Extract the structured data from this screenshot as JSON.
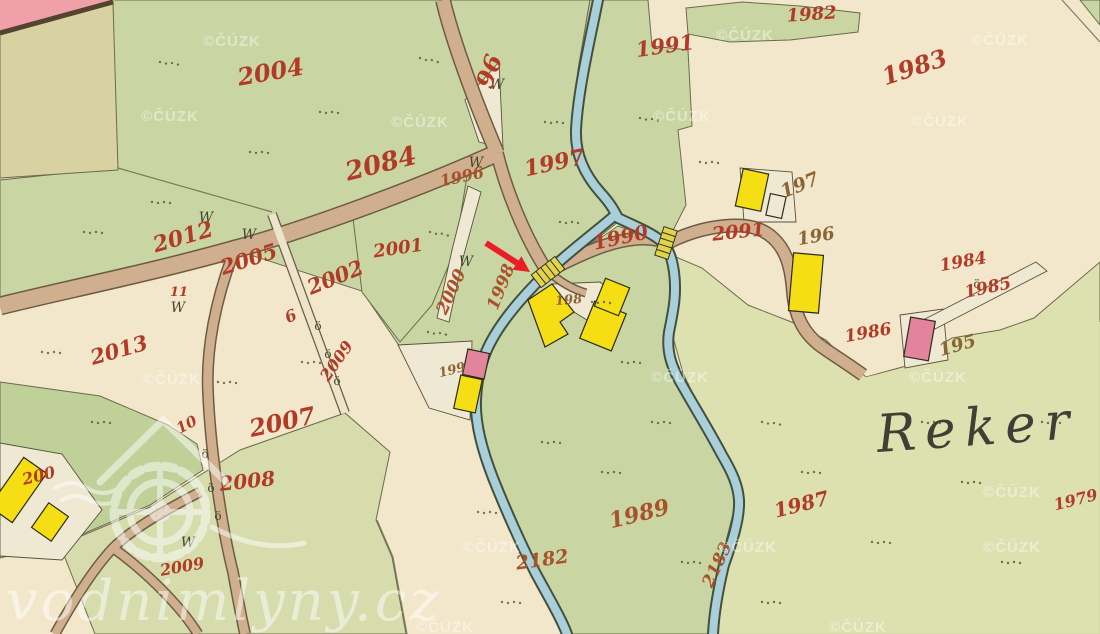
{
  "meta": {
    "title": "Historical cadastral map with water-mill location marker"
  },
  "watermarks": {
    "cuzk_text": "©ČÚZK",
    "cuzk_positions": [
      [
        232,
        46
      ],
      [
        170,
        121
      ],
      [
        420,
        127
      ],
      [
        745,
        40
      ],
      [
        1000,
        45
      ],
      [
        682,
        121
      ],
      [
        940,
        126
      ],
      [
        172,
        384
      ],
      [
        680,
        382
      ],
      [
        938,
        382
      ],
      [
        1012,
        497
      ],
      [
        492,
        552
      ],
      [
        748,
        552
      ],
      [
        1012,
        552
      ],
      [
        445,
        632
      ],
      [
        858,
        632
      ]
    ],
    "brand_text": "vodnimlyny.cz"
  },
  "place_label": {
    "text": "Reker"
  },
  "colors": {
    "paper": "#f2e7ca",
    "meadow": "#c9d6a3",
    "meadow_dark": "#bfd098",
    "meadow_pale": "#d6dcab",
    "meadow_se": "#dce1af",
    "boundary": "#6b6b4d",
    "white_parcel": "#efe8d2",
    "river": "#a8cfda",
    "river_edge": "#45503c",
    "road": "#cfaf8e",
    "road_edge": "#6d5c43",
    "lane": "#ece4cb",
    "building_wood": "#f6de14",
    "building_stone": "#e2849b",
    "bridge": "#e2d44a",
    "pink_area": "#efa0a8",
    "khaki_area": "#d8d2a2",
    "parcel_number": "#b23b28",
    "parcel_number_alt": "#a8512a",
    "house_number": "#8a6434",
    "place_name": "#3e4035",
    "arrow": "#ec1c24"
  },
  "parcel_labels": [
    {
      "t": "2004",
      "x": 272,
      "y": 80,
      "r": -10,
      "s": 24
    },
    {
      "t": "2084",
      "x": 383,
      "y": 172,
      "r": -14,
      "s": 26
    },
    {
      "t": "96",
      "x": 497,
      "y": 74,
      "r": -70,
      "s": 24
    },
    {
      "t": "1996",
      "x": 463,
      "y": 182,
      "r": -12,
      "s": 16,
      "c": "alt"
    },
    {
      "t": "1997",
      "x": 556,
      "y": 170,
      "r": -12,
      "s": 22
    },
    {
      "t": "1991",
      "x": 666,
      "y": 53,
      "r": -8,
      "s": 21
    },
    {
      "t": "1982",
      "x": 812,
      "y": 20,
      "r": -4,
      "s": 18
    },
    {
      "t": "1983",
      "x": 917,
      "y": 75,
      "r": -18,
      "s": 24
    },
    {
      "t": "2012",
      "x": 185,
      "y": 244,
      "r": -16,
      "s": 22
    },
    {
      "t": "2005",
      "x": 251,
      "y": 266,
      "r": -18,
      "s": 21
    },
    {
      "t": "2002",
      "x": 338,
      "y": 284,
      "r": -22,
      "s": 21
    },
    {
      "t": "2001",
      "x": 399,
      "y": 254,
      "r": -8,
      "s": 18
    },
    {
      "t": "2000",
      "x": 456,
      "y": 294,
      "r": -65,
      "s": 17,
      "c": "alt"
    },
    {
      "t": "1998",
      "x": 506,
      "y": 289,
      "r": -68,
      "s": 17,
      "c": "alt"
    },
    {
      "t": "1990",
      "x": 622,
      "y": 244,
      "r": -12,
      "s": 20
    },
    {
      "t": "2091",
      "x": 739,
      "y": 238,
      "r": -6,
      "s": 19
    },
    {
      "t": "2013",
      "x": 121,
      "y": 357,
      "r": -16,
      "s": 21
    },
    {
      "t": "11",
      "x": 179,
      "y": 296,
      "r": 0,
      "s": 13
    },
    {
      "t": "6",
      "x": 293,
      "y": 321,
      "r": -25,
      "s": 16
    },
    {
      "t": "2009",
      "x": 341,
      "y": 364,
      "r": -55,
      "s": 16
    },
    {
      "t": "10",
      "x": 189,
      "y": 429,
      "r": -28,
      "s": 15
    },
    {
      "t": "2007",
      "x": 284,
      "y": 430,
      "r": -12,
      "s": 24
    },
    {
      "t": "2008",
      "x": 248,
      "y": 488,
      "r": -6,
      "s": 20
    },
    {
      "t": "2009",
      "x": 183,
      "y": 572,
      "r": -10,
      "s": 16
    },
    {
      "t": "200",
      "x": 40,
      "y": 481,
      "r": -14,
      "s": 16
    },
    {
      "t": "1989",
      "x": 641,
      "y": 521,
      "r": -14,
      "s": 22,
      "c": "alt"
    },
    {
      "t": "2182",
      "x": 543,
      "y": 566,
      "r": -8,
      "s": 19,
      "c": "alt"
    },
    {
      "t": "2183",
      "x": 722,
      "y": 567,
      "r": -65,
      "s": 17,
      "c": "alt"
    },
    {
      "t": "1987",
      "x": 803,
      "y": 511,
      "r": -14,
      "s": 20
    },
    {
      "t": "1986",
      "x": 869,
      "y": 338,
      "r": -10,
      "s": 17
    },
    {
      "t": "1984",
      "x": 964,
      "y": 267,
      "r": -10,
      "s": 17
    },
    {
      "t": "1985",
      "x": 989,
      "y": 293,
      "r": -12,
      "s": 17
    },
    {
      "t": "1979",
      "x": 1077,
      "y": 505,
      "r": -14,
      "s": 16
    }
  ],
  "house_labels": [
    {
      "t": "197",
      "x": 802,
      "y": 191,
      "r": -22,
      "s": 19
    },
    {
      "t": "196",
      "x": 817,
      "y": 242,
      "r": -10,
      "s": 18
    },
    {
      "t": "195",
      "x": 959,
      "y": 351,
      "r": -16,
      "s": 18
    },
    {
      "t": "198",
      "x": 569,
      "y": 304,
      "r": -5,
      "s": 13
    },
    {
      "t": "199",
      "x": 453,
      "y": 374,
      "r": -14,
      "s": 13
    }
  ],
  "w_char": "W",
  "w_symbols": [
    [
      206,
      222
    ],
    [
      249,
      239
    ],
    [
      178,
      312
    ],
    [
      497,
      89
    ],
    [
      476,
      167
    ],
    [
      466,
      266
    ],
    [
      188,
      547
    ]
  ],
  "o_char": "ö",
  "o_symbols": [
    [
      318,
      330
    ],
    [
      328,
      358
    ],
    [
      337,
      385
    ],
    [
      205,
      458
    ],
    [
      211,
      492
    ],
    [
      218,
      520
    ],
    [
      977,
      288
    ]
  ],
  "dot_clusters": [
    [
      160,
      62,
      5
    ],
    [
      320,
      112,
      0
    ],
    [
      420,
      58,
      10
    ],
    [
      250,
      152,
      0
    ],
    [
      545,
      122,
      0
    ],
    [
      640,
      118,
      5
    ],
    [
      700,
      162,
      0
    ],
    [
      560,
      222,
      0
    ],
    [
      430,
      232,
      8
    ],
    [
      152,
      202,
      0
    ],
    [
      84,
      232,
      0
    ],
    [
      302,
      362,
      0
    ],
    [
      428,
      332,
      5
    ],
    [
      622,
      362,
      0
    ],
    [
      652,
      422,
      0
    ],
    [
      602,
      472,
      0
    ],
    [
      682,
      562,
      0
    ],
    [
      762,
      422,
      5
    ],
    [
      802,
      472,
      0
    ],
    [
      922,
      422,
      0
    ],
    [
      1002,
      562,
      0
    ],
    [
      872,
      542,
      0
    ],
    [
      502,
      602,
      0
    ],
    [
      218,
      382,
      0
    ],
    [
      92,
      422,
      0
    ],
    [
      42,
      352,
      0
    ],
    [
      962,
      482,
      0
    ],
    [
      1042,
      422,
      0
    ],
    [
      762,
      602,
      0
    ],
    [
      592,
      302,
      0
    ],
    [
      542,
      442,
      0
    ],
    [
      478,
      512,
      0
    ]
  ],
  "arrow": {
    "x1": 486,
    "y1": 243,
    "x2": 517,
    "y2": 263,
    "head": "530,272 512.6,269.7 521.4,256.3"
  }
}
